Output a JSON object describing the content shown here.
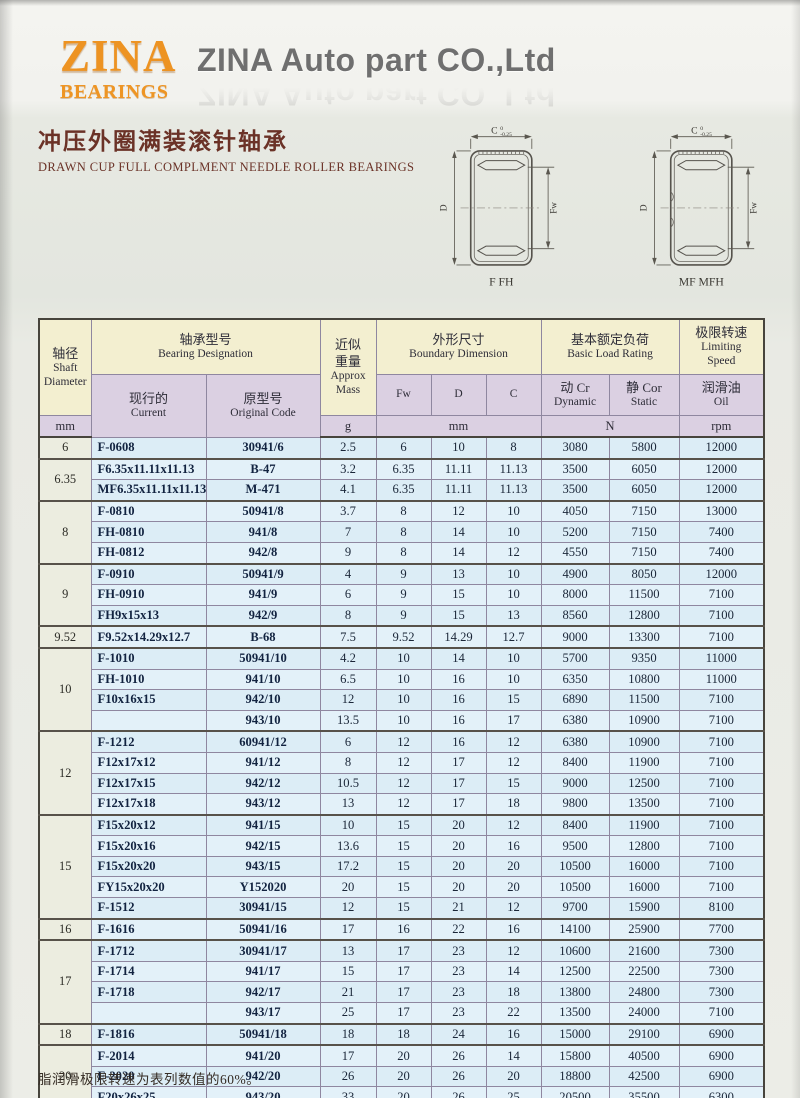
{
  "page": {
    "logo_line1": "ZINA",
    "logo_line2": "BEARINGS",
    "company_name": "ZINA Auto part CO.,Ltd",
    "title_cn": "冲压外圈满装滚针轴承",
    "title_en": "DRAWN CUP FULL COMPLMENT NEEDLE ROLLER BEARINGS",
    "footnote": "脂润滑极限转速为表列数值的60%。"
  },
  "colors": {
    "logo_orange": "#ed9322",
    "title_maroon": "#6b3227",
    "header_cream": "#f3efd0",
    "header_lavender": "#dbd0e2",
    "row_blue": "#dcedf6",
    "shaft_col": "#ecede0"
  },
  "diagrams": [
    {
      "caption": "F FH",
      "dim_c": "C",
      "tol_upper": "0",
      "tol_lower": "-0.25",
      "dim_d": "D",
      "dim_fw": "Fw"
    },
    {
      "caption": "MF MFH",
      "dim_c": "C",
      "tol_upper": "0",
      "tol_lower": "-0.25",
      "dim_d": "D",
      "dim_fw": "Fw"
    }
  ],
  "table": {
    "headers": {
      "shaft": {
        "cn": "轴径",
        "en1": "Shaft",
        "en2": "Diameter",
        "unit": "mm"
      },
      "designation": {
        "cn": "轴承型号",
        "en": "Bearing Designation"
      },
      "current": {
        "cn": "现行的",
        "en": "Current"
      },
      "original": {
        "cn": "原型号",
        "en": "Original Code"
      },
      "mass": {
        "cn1": "近似",
        "cn2": "重量",
        "en1": "Approx",
        "en2": "Mass",
        "unit": "g"
      },
      "boundary": {
        "cn": "外形尺寸",
        "en": "Boundary Dimension",
        "fw": "Fw",
        "d": "D",
        "c": "C",
        "unit": "mm"
      },
      "load": {
        "cn": "基本额定负荷",
        "en": "Basic Load Rating",
        "dyn_cn": "动 Cr",
        "dyn_en": "Dynamic",
        "sta_cn": "静 Cor",
        "sta_en": "Static",
        "unit": "N"
      },
      "speed": {
        "cn": "极限转速",
        "en1": "Limiting",
        "en2": "Speed",
        "oil_cn": "润滑油",
        "oil_en": "Oil",
        "unit": "rpm"
      }
    },
    "groups": [
      {
        "shaft": "6",
        "rows": [
          [
            "F-0608",
            "30941/6",
            "2.5",
            "6",
            "10",
            "8",
            "3080",
            "5800",
            "12000"
          ]
        ]
      },
      {
        "shaft": "6.35",
        "rows": [
          [
            "F6.35x11.11x11.13",
            "B-47",
            "3.2",
            "6.35",
            "11.11",
            "11.13",
            "3500",
            "6050",
            "12000"
          ],
          [
            "MF6.35x11.11x11.13",
            "M-471",
            "4.1",
            "6.35",
            "11.11",
            "11.13",
            "3500",
            "6050",
            "12000"
          ]
        ]
      },
      {
        "shaft": "8",
        "rows": [
          [
            "F-0810",
            "50941/8",
            "3.7",
            "8",
            "12",
            "10",
            "4050",
            "7150",
            "13000"
          ],
          [
            "FH-0810",
            "941/8",
            "7",
            "8",
            "14",
            "10",
            "5200",
            "7150",
            "7400"
          ],
          [
            "FH-0812",
            "942/8",
            "9",
            "8",
            "14",
            "12",
            "4550",
            "7150",
            "7400"
          ]
        ]
      },
      {
        "shaft": "9",
        "rows": [
          [
            "F-0910",
            "50941/9",
            "4",
            "9",
            "13",
            "10",
            "4900",
            "8050",
            "12000"
          ],
          [
            "FH-0910",
            "941/9",
            "6",
            "9",
            "15",
            "10",
            "8000",
            "11500",
            "7100"
          ],
          [
            "FH9x15x13",
            "942/9",
            "8",
            "9",
            "15",
            "13",
            "8560",
            "12800",
            "7100"
          ]
        ]
      },
      {
        "shaft": "9.52",
        "rows": [
          [
            "F9.52x14.29x12.7",
            "B-68",
            "7.5",
            "9.52",
            "14.29",
            "12.7",
            "9000",
            "13300",
            "7100"
          ]
        ]
      },
      {
        "shaft": "10",
        "rows": [
          [
            "F-1010",
            "50941/10",
            "4.2",
            "10",
            "14",
            "10",
            "5700",
            "9350",
            "11000"
          ],
          [
            "FH-1010",
            "941/10",
            "6.5",
            "10",
            "16",
            "10",
            "6350",
            "10800",
            "11000"
          ],
          [
            "F10x16x15",
            "942/10",
            "12",
            "10",
            "16",
            "15",
            "6890",
            "11500",
            "7100"
          ],
          [
            "",
            "943/10",
            "13.5",
            "10",
            "16",
            "17",
            "6380",
            "10900",
            "7100"
          ]
        ]
      },
      {
        "shaft": "12",
        "rows": [
          [
            "F-1212",
            "60941/12",
            "6",
            "12",
            "16",
            "12",
            "6380",
            "10900",
            "7100"
          ],
          [
            "F12x17x12",
            "941/12",
            "8",
            "12",
            "17",
            "12",
            "8400",
            "11900",
            "7100"
          ],
          [
            "F12x17x15",
            "942/12",
            "10.5",
            "12",
            "17",
            "15",
            "9000",
            "12500",
            "7100"
          ],
          [
            "F12x17x18",
            "943/12",
            "13",
            "12",
            "17",
            "18",
            "9800",
            "13500",
            "7100"
          ]
        ]
      },
      {
        "shaft": "15",
        "rows": [
          [
            "F15x20x12",
            "941/15",
            "10",
            "15",
            "20",
            "12",
            "8400",
            "11900",
            "7100"
          ],
          [
            "F15x20x16",
            "942/15",
            "13.6",
            "15",
            "20",
            "16",
            "9500",
            "12800",
            "7100"
          ],
          [
            "F15x20x20",
            "943/15",
            "17.2",
            "15",
            "20",
            "20",
            "10500",
            "16000",
            "7100"
          ],
          [
            "FY15x20x20",
            "Y152020",
            "20",
            "15",
            "20",
            "20",
            "10500",
            "16000",
            "7100"
          ],
          [
            "F-1512",
            "30941/15",
            "12",
            "15",
            "21",
            "12",
            "9700",
            "15900",
            "8100"
          ]
        ]
      },
      {
        "shaft": "16",
        "rows": [
          [
            "F-1616",
            "50941/16",
            "17",
            "16",
            "22",
            "16",
            "14100",
            "25900",
            "7700"
          ]
        ]
      },
      {
        "shaft": "17",
        "rows": [
          [
            "F-1712",
            "30941/17",
            "13",
            "17",
            "23",
            "12",
            "10600",
            "21600",
            "7300"
          ],
          [
            "F-1714",
            "941/17",
            "15",
            "17",
            "23",
            "14",
            "12500",
            "22500",
            "7300"
          ],
          [
            "F-1718",
            "942/17",
            "21",
            "17",
            "23",
            "18",
            "13800",
            "24800",
            "7300"
          ],
          [
            "",
            "943/17",
            "25",
            "17",
            "23",
            "22",
            "13500",
            "24000",
            "7100"
          ]
        ]
      },
      {
        "shaft": "18",
        "rows": [
          [
            "F-1816",
            "50941/18",
            "18",
            "18",
            "24",
            "16",
            "15000",
            "29100",
            "6900"
          ]
        ]
      },
      {
        "shaft": "20",
        "rows": [
          [
            "F-2014",
            "941/20",
            "17",
            "20",
            "26",
            "14",
            "15800",
            "40500",
            "6900"
          ],
          [
            "F-2020",
            "942/20",
            "26",
            "20",
            "26",
            "20",
            "18800",
            "42500",
            "6900"
          ],
          [
            "F20x26x25",
            "943/20",
            "33",
            "20",
            "26",
            "25",
            "20500",
            "35500",
            "6300"
          ]
        ]
      }
    ]
  }
}
